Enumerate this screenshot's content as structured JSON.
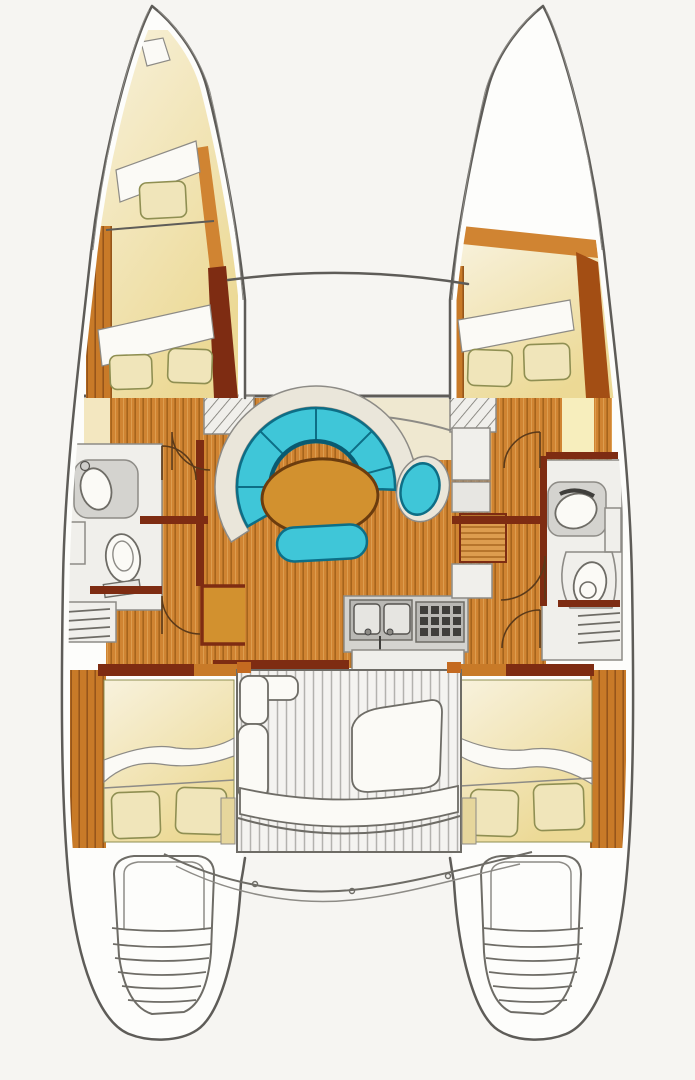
{
  "meta": {
    "type": "floor-plan",
    "subject": "catamaran-interior-layout-top-view"
  },
  "palette": {
    "paper": "#f6f5f2",
    "hull-fill": "#fdfdfb",
    "bridge": "#f7f6f3",
    "outline": "#5e5c58",
    "outline-soft": "#8d8b86",
    "outline-strong": "#6e6c66",
    "room-white": "#f0efeb",
    "cream": "#f3e7c0",
    "cream-deep": "#ecd998",
    "sheet": "#fbfaf6",
    "pillow": "#f0e5ba",
    "pillow-line": "#8f8f52",
    "wood": "#d08432",
    "wood-light": "#dd9d4f",
    "wood-deep": "#c87a28",
    "plank": "#a6641c",
    "maroon": "#7e2c12",
    "rust": "#a34e14",
    "teal": "#3fc6d8",
    "teal-dark": "#0d6e86",
    "teal-deep": "#0a5a70",
    "rim": "#eae6da",
    "table": "#d2912f",
    "table-line": "#6b3c0e",
    "counter": "#d4d3cf",
    "appliance": "#b9b8b4",
    "grid-dark": "#3f3e3b",
    "deck": "#f4f3f0",
    "deck-line": "#b3b2ae",
    "door": "#5b3a1a",
    "accent-cushion": "#e6d69c"
  },
  "regions": {
    "boat": "Catamaran interior layout, top-view floor plan",
    "foredeck": "Foredeck / trampoline area between bows",
    "beam": "Forward crossbeam",
    "port_bow": "Port bow single berth with pillow",
    "port_fwd_berth": "Port forward V-berth with two pillows",
    "stbd_fwd_berth": "Starboard forward V-berth with two pillows",
    "port_head": "Port head: washbasin, toilet, steps",
    "stbd_head": "Starboard head: washbasin, toilet, steps",
    "salon": "Salon on bridgedeck",
    "settee": "Curved teal settee",
    "table": "Oval salon table",
    "bench": "Teal settee bench",
    "nav": "Chart desk with half-round seat",
    "galley": "Galley: twin sink and stove",
    "cockpit": "Aft cockpit with teak deck and seats",
    "port_aft_cabin": "Port aft double berth",
    "stbd_aft_cabin": "Starboard aft double berth",
    "port_transom": "Port transom swim steps",
    "stbd_transom": "Starboard transom swim steps",
    "aft_beam": "Aft crossbeam / davit lines"
  }
}
